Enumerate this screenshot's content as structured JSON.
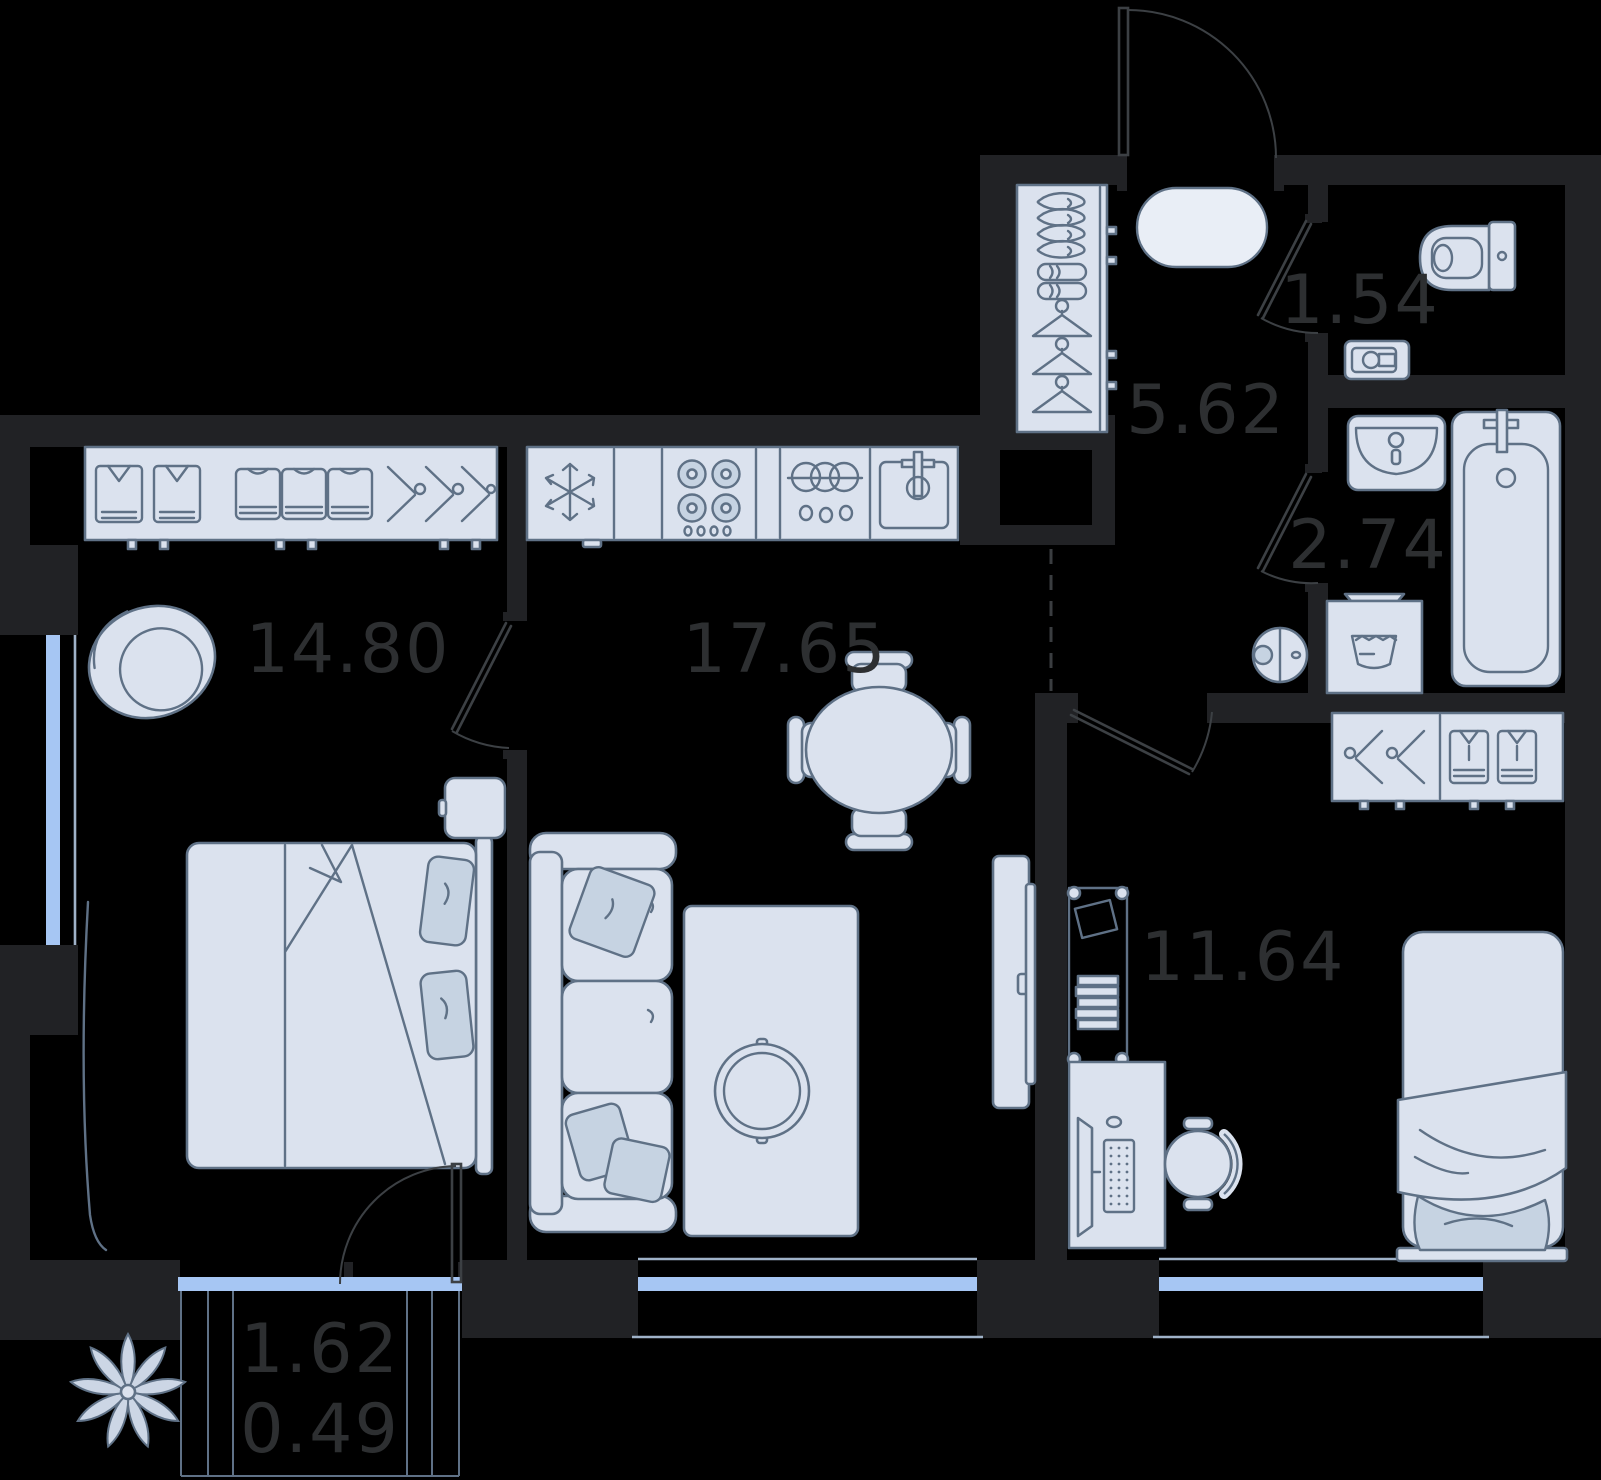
{
  "plan": {
    "type": "apartment-floor-plan",
    "rooms": [
      {
        "id": "bedroom-main",
        "area": "14.80"
      },
      {
        "id": "kitchen-living-room",
        "area": "17.65"
      },
      {
        "id": "hallway",
        "area": "5.62"
      },
      {
        "id": "wc",
        "area": "1.54"
      },
      {
        "id": "bathroom",
        "area": "2.74"
      },
      {
        "id": "bedroom-second",
        "area": "11.64"
      }
    ],
    "balcony": {
      "area_total": "1.62",
      "area_counted": "0.49"
    },
    "colors": {
      "background": "#000000",
      "wall": "#212225",
      "furniture_fill": "#dbe2ee",
      "furniture_soft": "#c6d3e2",
      "furniture_stroke": "#5f7186",
      "rug_fill": "#e9eef6",
      "window_glass": "#a6c6f3",
      "window_frame": "#9fb2c8",
      "door_line": "#3c4044",
      "dash_line": "#3a3d40",
      "label_text": "#2d2f31"
    },
    "furniture": [
      "wardrobe",
      "double-bed",
      "nightstand",
      "armchair",
      "plant",
      "curtain",
      "fridge",
      "stove",
      "dishwasher",
      "kitchen-sink",
      "dining-table",
      "dining-chair",
      "sofa",
      "pillow",
      "rug",
      "coffee-table",
      "tv-stand",
      "shoe-cabinet",
      "entry-mat",
      "toilet",
      "wash-basin",
      "sink-vanity",
      "bathtub",
      "washing-machine",
      "robot-vacuum",
      "shelving-unit",
      "desk",
      "computer",
      "desk-chair",
      "single-bed",
      "window",
      "door",
      "ventilation-shaft"
    ]
  }
}
